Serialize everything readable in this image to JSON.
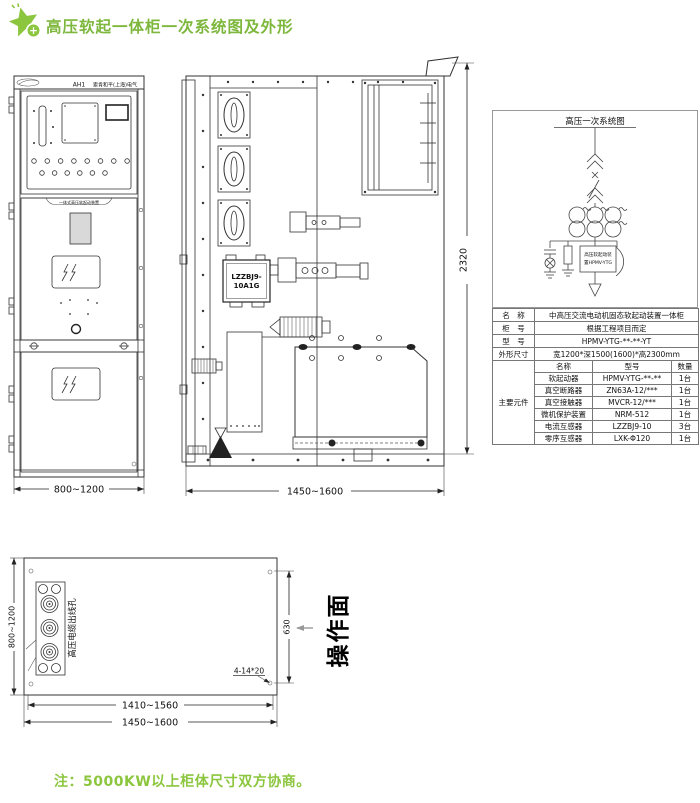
{
  "header": {
    "title": "高压软起一体柜一次系统图及外形",
    "badge": "+",
    "accent_color": "#8cc63e"
  },
  "front_view": {
    "panel_code": "AH1",
    "company": "索肯和平(上海)电气",
    "band_label": "一体式高压软起动装置",
    "dim_width": "800~1200"
  },
  "side_view": {
    "ct_label_line1": "LZZBJ9-",
    "ct_label_line2": "10A1G",
    "dim_height": "2320",
    "dim_width": "1450~1600"
  },
  "schematic": {
    "title": "高压一次系统图",
    "device_line1": "高压软起动装",
    "device_line2": "置HPMV-YTG"
  },
  "spec_table": {
    "rows": [
      {
        "label": "名　称",
        "value": "中高压交流电动机固态软起动装置一体柜"
      },
      {
        "label": "柜　号",
        "value": "根据工程项目而定"
      },
      {
        "label": "型　号",
        "value": "HPMV-YTG-**-**-YT"
      },
      {
        "label": "外形尺寸",
        "value": "宽1200*深1500(1600)*高2300mm"
      }
    ],
    "group_label": "主要元件",
    "sub_header": {
      "name": "名称",
      "model": "型号",
      "qty": "数量"
    },
    "components": [
      {
        "name": "软起动器",
        "model": "HPMV-YTG-**-**",
        "qty": "1台"
      },
      {
        "name": "真空断路器",
        "model": "ZN63A-12/***",
        "qty": "1台"
      },
      {
        "name": "真空接触器",
        "model": "MVCR-12/***",
        "qty": "1台"
      },
      {
        "name": "微机保护装置",
        "model": "NRM-512",
        "qty": "1台"
      },
      {
        "name": "电流互感器",
        "model": "LZZBJ9-10",
        "qty": "3台"
      },
      {
        "name": "零序互感器",
        "model": "LXK-Φ120",
        "qty": "1台"
      }
    ]
  },
  "plan_view": {
    "cable_hole_label": "高压电缆出线孔",
    "dim_left": "800~1200",
    "dim_right": "630",
    "holes_note": "4-14*20",
    "dim_inner": "1410~1560",
    "dim_outer": "1450~1600",
    "operation_face_label": "操作面"
  },
  "footer": {
    "note": "注：5000KW以上柜体尺寸双方协商。"
  }
}
